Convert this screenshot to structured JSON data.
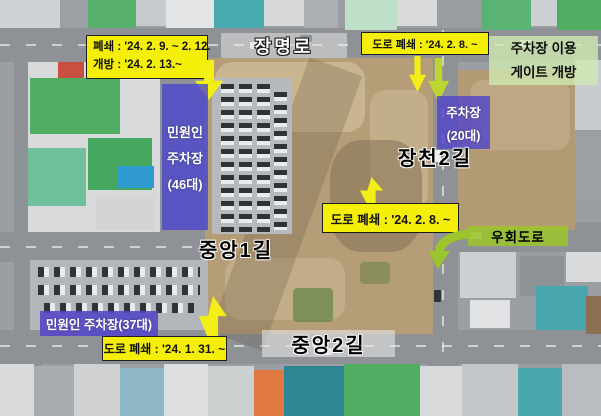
{
  "colors": {
    "annotation_yellow": "#f4ee09",
    "annotation_purple": "#5648c6",
    "detour_green": "#9cc42c",
    "arrow_lime": "#bcd530",
    "gate_notice_green": "#d0e9b2"
  },
  "annotations": {
    "closure_schedule": {
      "line1": "폐쇄 : '24. 2. 9. ~ 2. 12.",
      "line2": "개방 : '24. 2. 13.~"
    },
    "road_closure_top": "도로 폐쇄 : '24. 2. 8. ~",
    "gate_notice": {
      "line1": "주차장 이용",
      "line2": "게이트 개방"
    },
    "parking_small": {
      "line1": "주차장",
      "line2": "(20대)"
    },
    "road_closure_mid": "도로 폐쇄 : '24. 2. 8. ~",
    "detour_label": "우회도로",
    "parking_strip": {
      "line1": "민원인",
      "line2": "주차장",
      "line3": "(46대)"
    },
    "parking_lot": "민원인 주차장(37대)",
    "road_closure_bottom": "도로 폐쇄 : '24. 1. 31. ~"
  },
  "roads": {
    "jangmyeong_ro": "장명로",
    "jangcheon_2gil": "장천2길",
    "jungang_1gil": "중앙1길",
    "jungang_2gil": "중앙2길"
  }
}
